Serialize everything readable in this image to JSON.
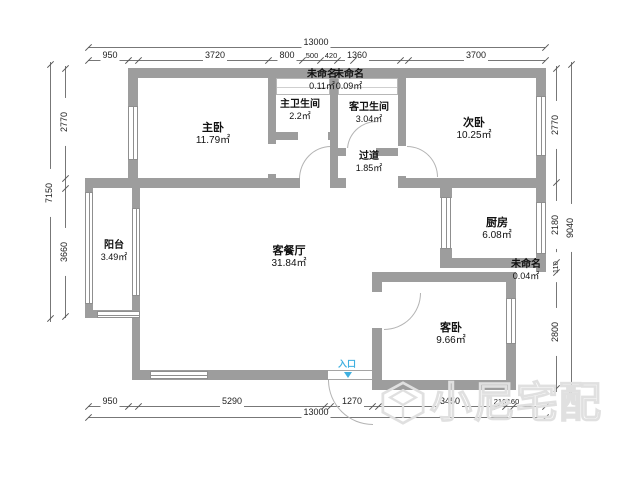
{
  "title": "apartment-floor-plan",
  "colors": {
    "wall": "#9d9d9d",
    "entrance_accent": "#3fb0e0",
    "watermark": "#e0e0e0"
  },
  "entrance": {
    "label": "入口"
  },
  "watermark": {
    "text": "小尼宅配"
  },
  "rooms": [
    {
      "id": "master-bedroom",
      "name": "主卧",
      "area": "11.79㎡"
    },
    {
      "id": "master-bathroom",
      "name": "主卫生间",
      "area": "2.2㎡"
    },
    {
      "id": "unnamed-1",
      "name": "未命名",
      "area": "0.11㎡"
    },
    {
      "id": "unnamed-2",
      "name": "未命名",
      "area": "0.09㎡"
    },
    {
      "id": "guest-bathroom",
      "name": "客卫生间",
      "area": "3.04㎡"
    },
    {
      "id": "second-bedroom",
      "name": "次卧",
      "area": "10.25㎡"
    },
    {
      "id": "hallway",
      "name": "过道",
      "area": "1.85㎡"
    },
    {
      "id": "kitchen",
      "name": "厨房",
      "area": "6.08㎡"
    },
    {
      "id": "unnamed-3",
      "name": "未命名",
      "area": "0.04㎡"
    },
    {
      "id": "balcony",
      "name": "阳台",
      "area": "3.49㎡"
    },
    {
      "id": "living-dining",
      "name": "客餐厅",
      "area": "31.84㎡"
    },
    {
      "id": "guest-bedroom",
      "name": "客卧",
      "area": "9.66㎡"
    }
  ],
  "dimensions": {
    "top_total": "13000",
    "top_segments": [
      "950",
      "3720",
      "800",
      "500",
      "420",
      "1360",
      "3700"
    ],
    "bottom_total": "13000",
    "bottom_segments": [
      "950",
      "5290",
      "1270",
      "3450",
      "210",
      "160"
    ],
    "left_total": "7150",
    "left_segments": [
      "2770",
      "3660"
    ],
    "right_total": "9040",
    "right_segments": [
      "2770",
      "2180",
      "110",
      "2800"
    ]
  }
}
